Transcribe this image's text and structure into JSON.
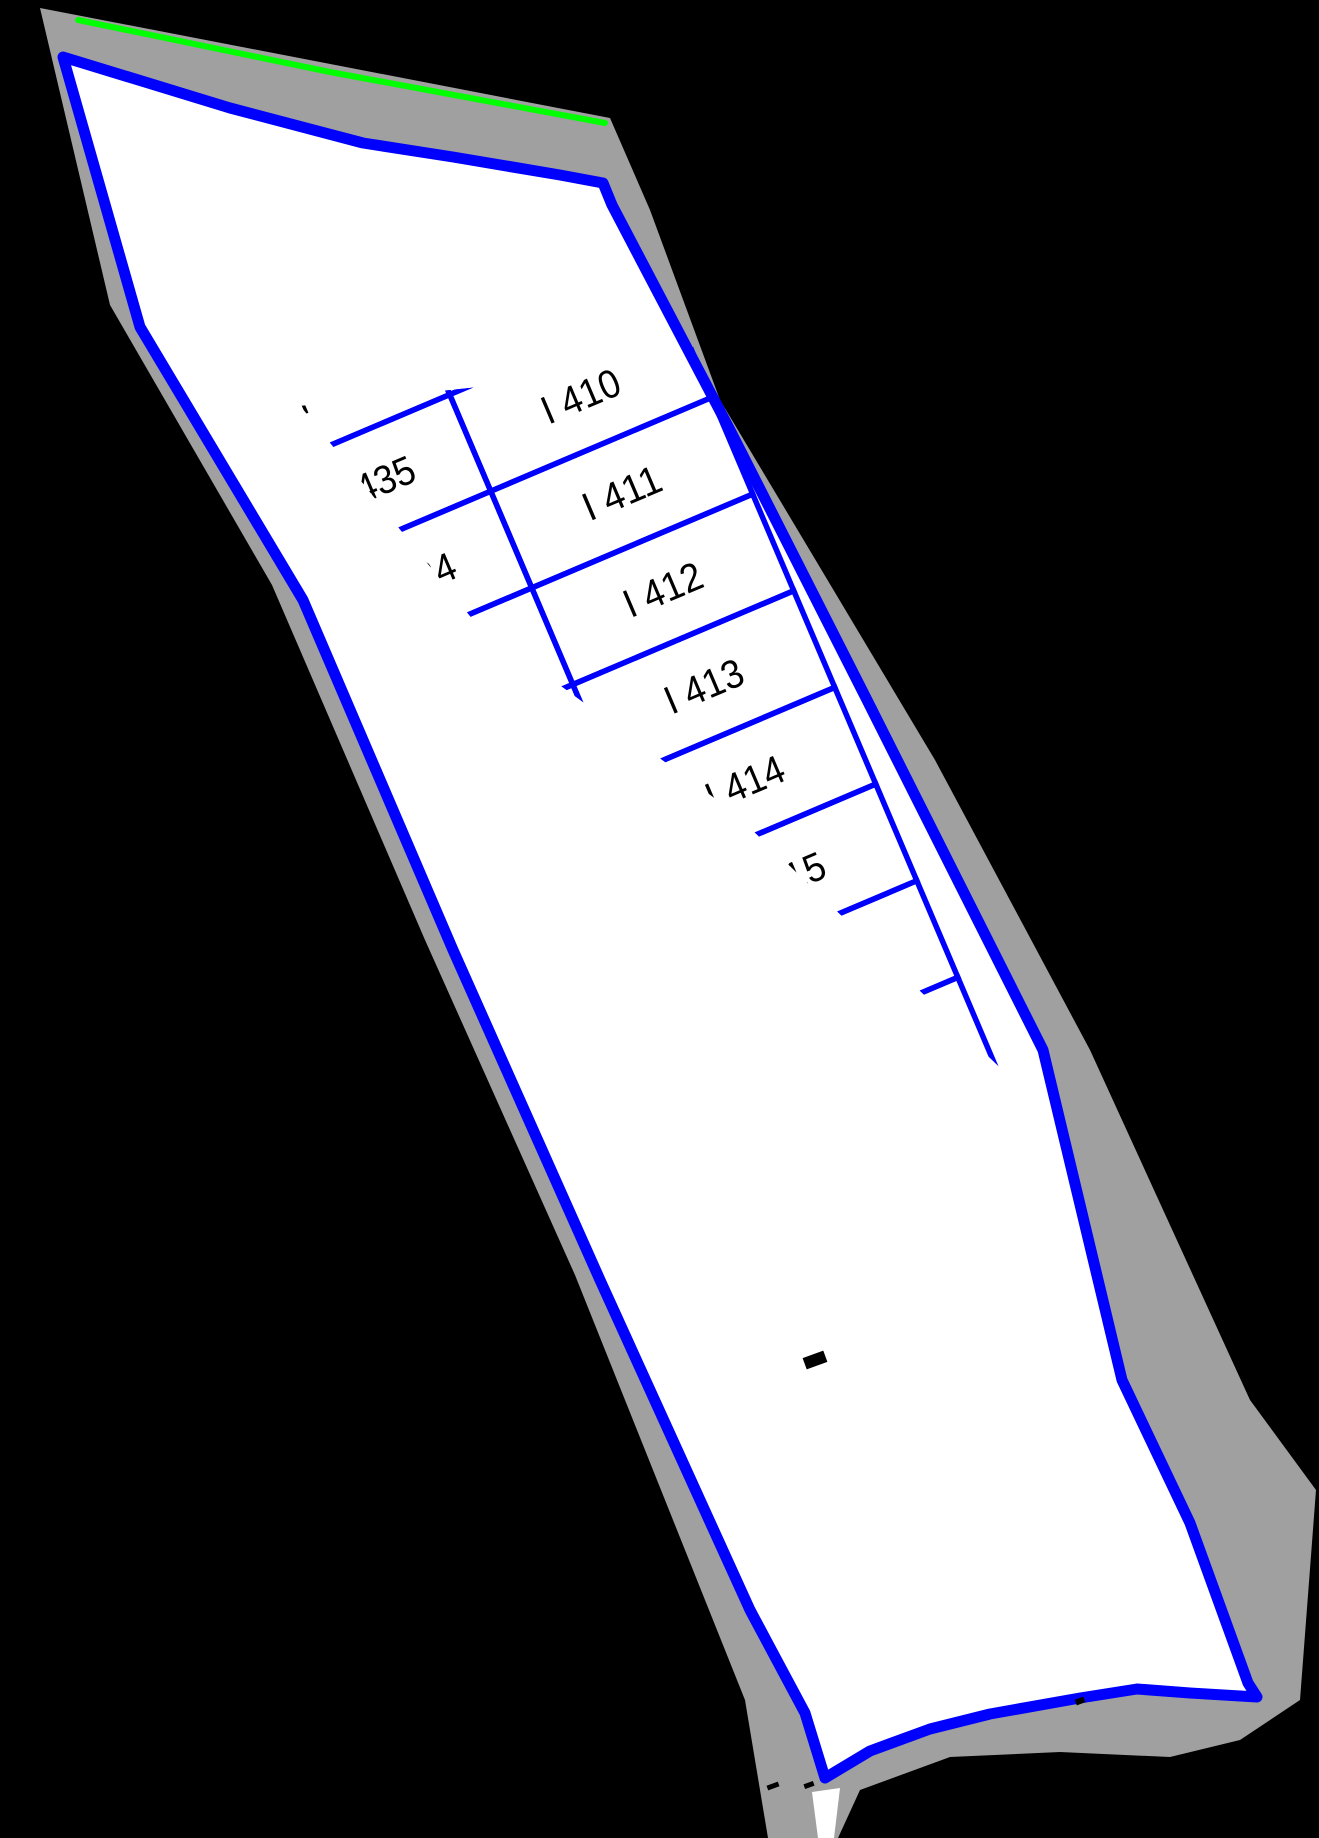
{
  "sector": {
    "label": "SECTOR I"
  },
  "lots": {
    "top": "I 408",
    "left_column": [
      "I 436",
      "I 435",
      "I 434",
      "I 433",
      "I 432",
      "I 431",
      "I 430",
      "I 429",
      "I 428",
      "I 427",
      "I 426",
      "I 425",
      "I 424",
      "I 423"
    ],
    "right_column": [
      "I 409",
      "I 410",
      "I 411",
      "I 412",
      "I 413",
      "I 414",
      "I 415",
      "I 416",
      "I 417",
      "I 418",
      "I 419",
      "I 420",
      "I 421",
      "I 422"
    ]
  },
  "colors": {
    "background": "#000000",
    "band_gray": "#A0A0A0",
    "parcel_blue": "#0000FF",
    "edge_green": "#00FF00",
    "sector_white": "#FFFFFF",
    "label_black": "#000000"
  }
}
